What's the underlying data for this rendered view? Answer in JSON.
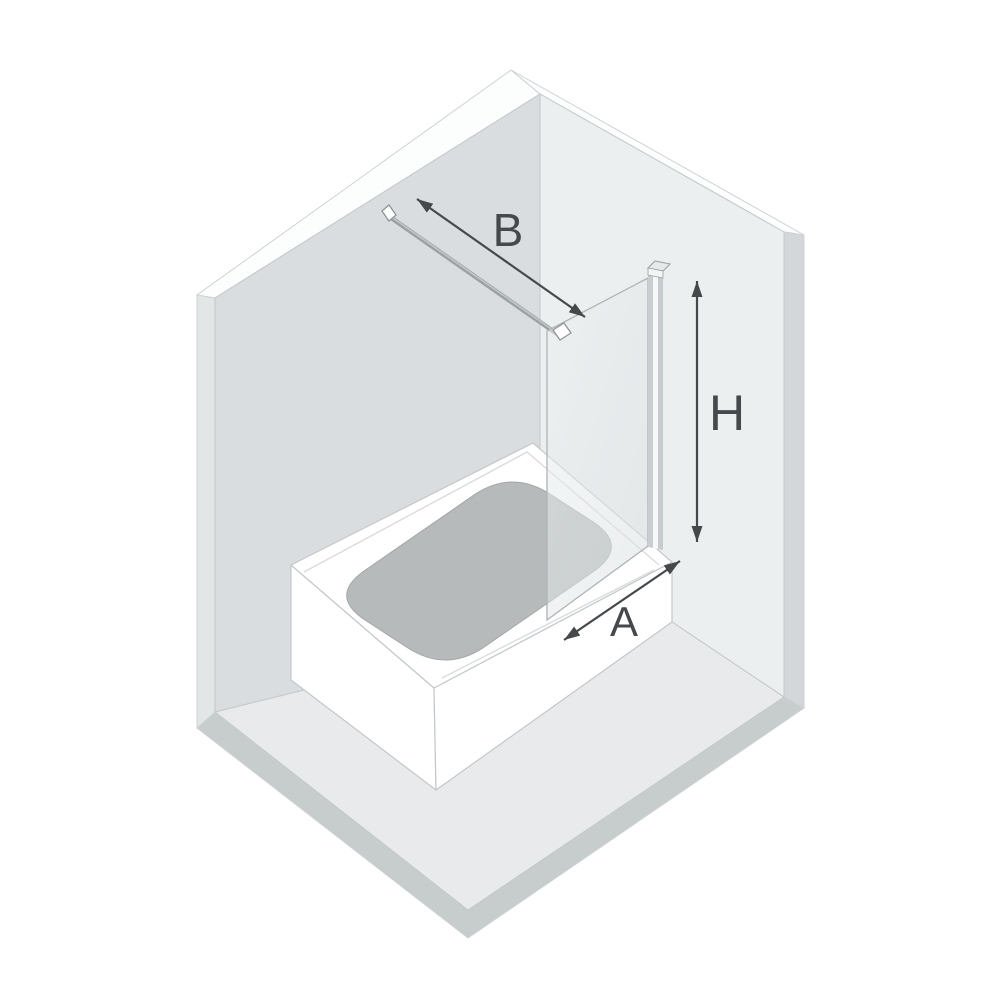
{
  "diagram": {
    "title": "bath-screen-dimension-diagram",
    "labels": {
      "top_width": "B",
      "height": "H",
      "bottom_width": "A"
    },
    "colors": {
      "background": "#ffffff",
      "left_wall": "#dadddf",
      "right_wall": "#eceff0",
      "floor": "#e8eaeb",
      "floor_edge": "#c7cccd",
      "wall_edge_left": "#e3e6e7",
      "wall_edge_right": "#d3d7d9",
      "wall_top_edge": "#fcfdfd",
      "tub": "#ffffff",
      "basin": "#b6babb",
      "basin_outline": "#a2a7a9",
      "glass_outline": "#aeb4b6",
      "profile_light": "#f7f9f9",
      "profile_dark": "#c6cbcd",
      "hardware": "#a4a9ab",
      "hardware_outline": "#8f9597",
      "dimension": "#46494b"
    }
  }
}
